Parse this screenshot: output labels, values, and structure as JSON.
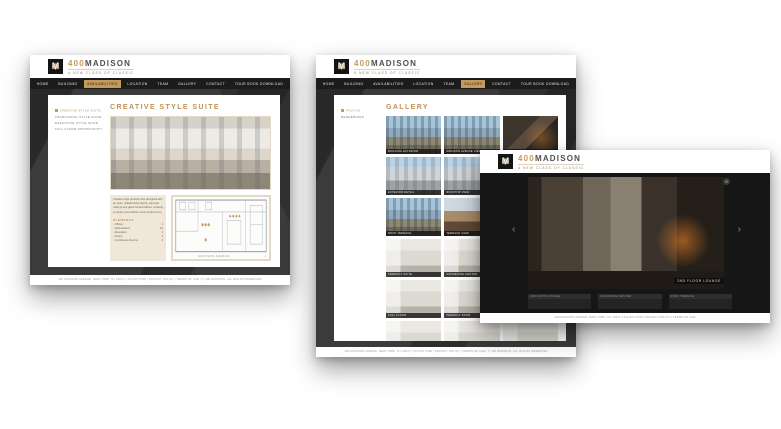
{
  "brand": {
    "monogram": "M",
    "number": "400",
    "name": "MADISON",
    "tagline": "A NEW CLASS OF CLASSIC"
  },
  "colors": {
    "gold": "#c49a5a",
    "nav_bg": "#1c1c1c",
    "panel_bg": "#3b3b3b",
    "beige": "#efe8d8"
  },
  "nav": {
    "items": [
      "HOME",
      "BUILDING",
      "AVAILABILITIES",
      "LOCATION",
      "TEAM",
      "GALLERY",
      "CONTACT",
      "TOUR BOOK DOWNLOAD"
    ]
  },
  "availability_page": {
    "active_nav": "AVAILABILITIES",
    "title": "CREATIVE STYLE SUITE",
    "sidebar": [
      {
        "label": "CREATIVE STYLE SUITE",
        "active": true
      },
      {
        "label": "TRADITIONAL STYLE SUITE"
      },
      {
        "label": "EXECUTIVE STYLE SUITE"
      },
      {
        "label": "FULL FLOOR OPPORTUNITY"
      }
    ],
    "description": "Creative style prebuilt suite designed with an open, collaborative layout, exposed ceilings and glass fronted offices, creating a modern and efficient work environment.",
    "elements_label": "ELEMENTS",
    "elements": [
      {
        "label": "Offices",
        "value": "1"
      },
      {
        "label": "Workstations",
        "value": "22"
      },
      {
        "label": "Reception",
        "value": "1"
      },
      {
        "label": "Pantry",
        "value": "1"
      },
      {
        "label": "Conference Rooms",
        "value": "2"
      }
    ],
    "floorplan_street": "MADISON AVENUE",
    "footer": "400 MADISON AVENUE, NEW YORK, NY 10017  |  212.867.5300  |  PRIVACY POLICY  |  TERMS OF USE  |  © 400 MADISON. ALL RIGHTS RESERVED"
  },
  "gallery_page": {
    "active_nav": "GALLERY",
    "title": "GALLERY",
    "sidebar": [
      {
        "label": "PHOTOS",
        "active": true
      },
      {
        "label": "RENDERINGS"
      }
    ],
    "thumbs": [
      {
        "label": "BUILDING EXTERIOR",
        "tone": "city"
      },
      {
        "label": "MADISON AVENUE VIEW",
        "tone": "city"
      },
      {
        "label": "BUILDING ENTRANCE",
        "tone": "dark"
      },
      {
        "label": "EXTERIOR DETAIL",
        "tone": "stone"
      },
      {
        "label": "ROOFTOP VIEW",
        "tone": "stone"
      },
      {
        "label": "LOBBY",
        "tone": "dark"
      },
      {
        "label": "ROOF TERRACE",
        "tone": "city"
      },
      {
        "label": "TERRACE VIEW",
        "tone": "wood"
      },
      {
        "label": "2ND FLOOR LOUNGE",
        "tone": "dark"
      },
      {
        "label": "PREBUILT SUITE",
        "tone": "interior"
      },
      {
        "label": "CONVENING CENTER",
        "tone": "interior"
      },
      {
        "label": "LOUNGE DETAIL",
        "tone": "dark"
      },
      {
        "label": "FULL FLOOR",
        "tone": "interior"
      },
      {
        "label": "PREBUILT STAIR",
        "tone": "interior"
      },
      {
        "label": "SUITE 500",
        "tone": "interior"
      },
      {
        "label": "SUITE 600",
        "tone": "interior"
      },
      {
        "label": "SUITE 700",
        "tone": "interior"
      },
      {
        "label": "SUITE 800",
        "tone": "interior"
      }
    ],
    "footer": "400 MADISON AVENUE, NEW YORK, NY 10017  |  212.867.5300  |  PRIVACY POLICY  |  TERMS OF USE  |  © 400 MADISON. ALL RIGHTS RESERVED"
  },
  "lightbox_page": {
    "caption": "2ND FLOOR LOUNGE",
    "close_icon": "✕",
    "prev_icon": "‹",
    "next_icon": "›",
    "thumbs": [
      {
        "label": "2ND FLOOR LOUNGE"
      },
      {
        "label": "CONVENING CENTER"
      },
      {
        "label": "ROOF TERRACE"
      }
    ],
    "footer": "400 MADISON AVENUE, NEW YORK, NY 10017  |  212.867.5300  |  PRIVACY POLICY  |  TERMS OF USE"
  }
}
